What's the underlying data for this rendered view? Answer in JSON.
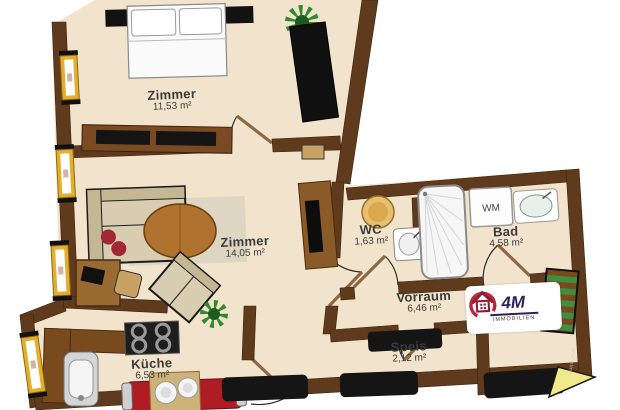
{
  "plan_title": "apartment floor plan",
  "rooms": [
    {
      "id": "zimmer1",
      "name": "Zimmer",
      "area": "11,53 m²"
    },
    {
      "id": "zimmer2",
      "name": "Zimmer",
      "area": "14,05 m²"
    },
    {
      "id": "wc",
      "name": "WC",
      "area": "1,63 m²"
    },
    {
      "id": "bad",
      "name": "Bad",
      "area": "4,58 m²"
    },
    {
      "id": "vorraum",
      "name": "Vorraum",
      "area": "6,46 m²"
    },
    {
      "id": "speis",
      "name": "Speis",
      "area": "2,12 m²"
    },
    {
      "id": "kueche",
      "name": "Küche",
      "area": "6,53 m²"
    }
  ],
  "labels": {
    "washing_machine": "WM"
  },
  "logo": {
    "brand": "4M",
    "subtitle": "IMMOBILIEN"
  },
  "watermark": "WGOnline",
  "colors": {
    "wall": "#5f3a1c",
    "floor": "#f2e4cc",
    "window_frame": "#e5af2d",
    "logo_red": "#c2233a",
    "logo_navy": "#2d2158",
    "plant_green": "#2e8b2e",
    "bench_red": "#b01c24",
    "marker_yellow": "#f1e98a"
  }
}
